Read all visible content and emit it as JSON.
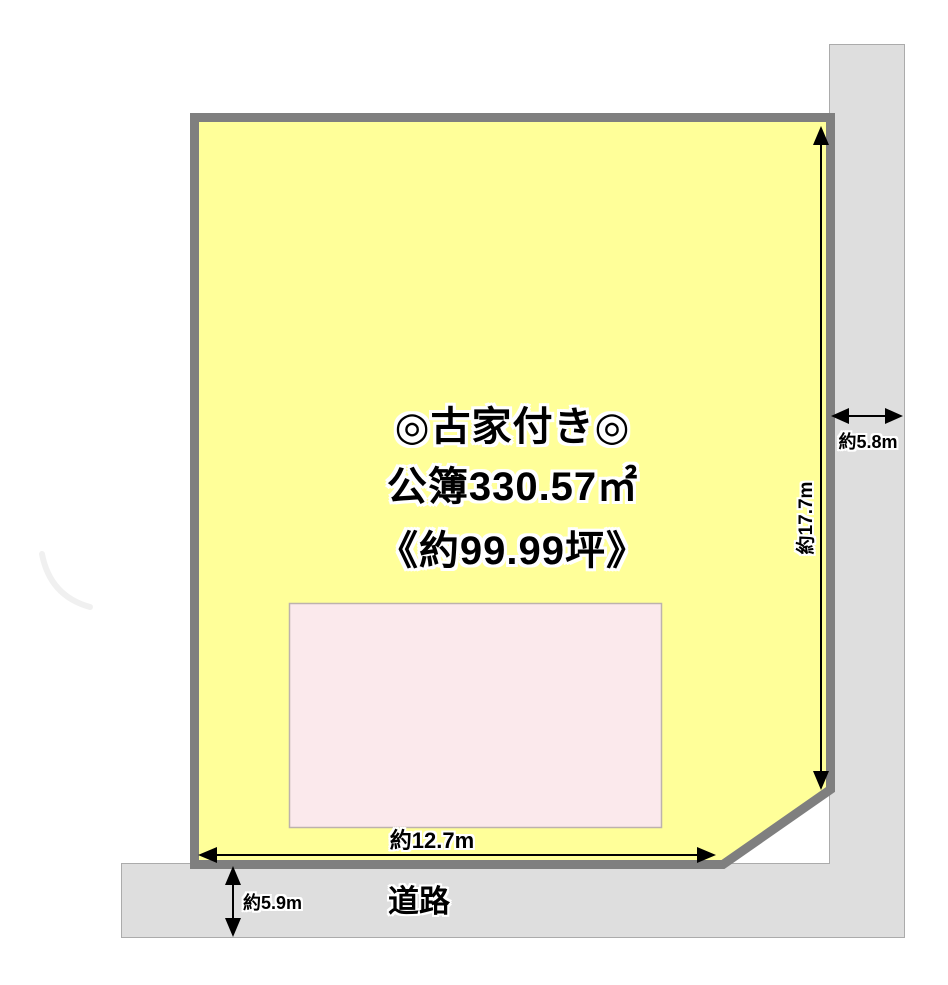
{
  "diagram": {
    "notes": {
      "line1": "◎古家付き◎",
      "line2": "公簿330.57㎡",
      "line3": "《約99.99坪》"
    },
    "dimensions": {
      "east_depth": "約17.7m",
      "right_road_width": "約5.8m",
      "south_frontage": "約12.7m",
      "bottom_road_width": "約5.9m"
    },
    "labels": {
      "road": "道路"
    },
    "colors": {
      "land_fill": "#ffff99",
      "land_border": "#7f7f7f",
      "road_fill": "#dedede",
      "road_border": "#ababab",
      "building_fill": "#fbe9ec",
      "building_border": "#bdb2ad",
      "arrow": "#000000",
      "text": "#000000",
      "text_outline": "#ffffff"
    }
  }
}
